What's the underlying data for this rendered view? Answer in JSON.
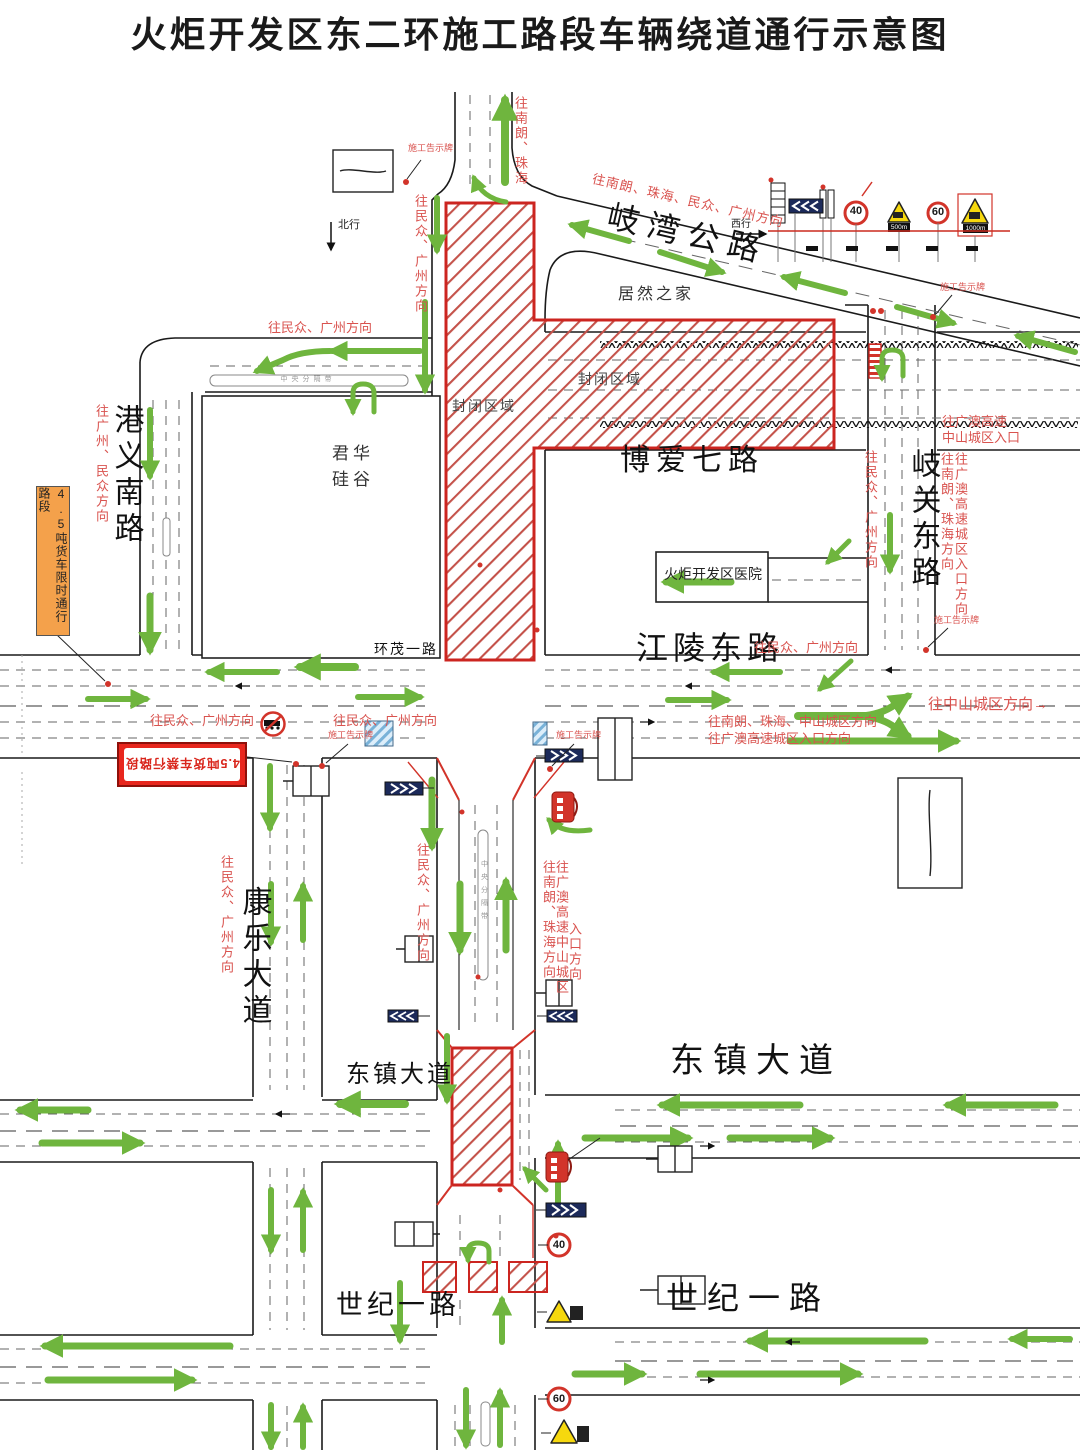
{
  "title": "火炬开发区东二环施工路段车辆绕道通行示意图",
  "colors": {
    "closure_red": "#d2342a",
    "arrow_green": "#6fb53e",
    "direction_red": "#d9534f",
    "limit_sign_orange": "#f4a14b",
    "ban_sign_red": "#e8261d",
    "chevron_board_blue": "#1c2a5a",
    "warning_yellow": "#f6d80e"
  },
  "roads": {
    "qiwan": {
      "label": "岐湾公路"
    },
    "boai_qi": {
      "label": "博爱七路"
    },
    "jiangling_dong": {
      "label": "江陵东路"
    },
    "huanmao_yi": {
      "label": "环茂一路"
    },
    "gangyi_nan": {
      "label": "港义南路"
    },
    "qiguan_dong": {
      "label": "岐关东路"
    },
    "kangle": {
      "label": "康乐大道"
    },
    "dongzhen_right": {
      "label": "东镇大道"
    },
    "dongzhen_left": {
      "label": "东镇大道"
    },
    "shiji_right": {
      "label": "世纪一路"
    },
    "shiji_left": {
      "label": "世纪一路"
    }
  },
  "places": {
    "juran_home": "居然之家",
    "junhua_line1": "君华",
    "junhua_line2": "硅谷",
    "hospital": "火炬开发区医院"
  },
  "closed_zone": {
    "label_a": "封闭区域",
    "label_b": "封闭区域"
  },
  "median_label": "中央分隔带",
  "direction_labels": {
    "to_nanlang_zhuhai_top": "往南朗、珠海",
    "to_minzhong_gz_top": "往民众、广州方向",
    "qiwan_diagonal": "往南朗、珠海、民众、广州方向",
    "west_street": "往民众、广州方向",
    "gangyi_side": "往广州、民众方向",
    "qiguan_left": "往民众、广州方向",
    "qiguan_right1": "往南朗、珠海方向",
    "qiguan_right2": "往广澳高速城区入口方向",
    "gaoao_entry_line1": "往广澳高速",
    "gaoao_entry_line2": "中山城区入口",
    "jiangling_side": "往民众、广州方向",
    "to_zhongshan_city": "往中山城区方向→",
    "east_exit_line1": "往南朗、珠海、中山城区方向",
    "east_exit_line2": "往广澳高速城区入口方向",
    "kangle_west1": "往民众、广州方向",
    "kangle_west2": "往民众、广州方向",
    "kangle_vert": "往民众、广州方向",
    "center_left_vert": "往民众、广州方向",
    "center_right_vert1": "往南朗、珠海方向",
    "center_right_vert2": "往广澳高速中山城区",
    "center_right_vert3": "入口方向"
  },
  "annotations": {
    "notice_board": "施工告示牌",
    "truck_limit": "4.5吨货车限时通行路段",
    "truck_ban": "4.5吨货车禁行路段",
    "north_bound": "北行",
    "west_bound": "西行"
  },
  "sign_legend": {
    "speed_40": "40",
    "speed_60": "60",
    "dist_500": "500m",
    "dist_1000": "1000m"
  }
}
